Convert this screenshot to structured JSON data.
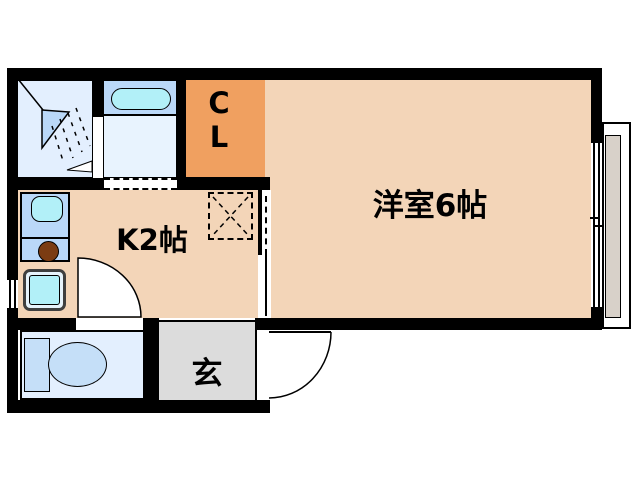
{
  "plan": {
    "rooms": {
      "western_room": {
        "label": "洋室6帖"
      },
      "kitchen": {
        "label": "K2帖"
      },
      "closet": {
        "label_top": "C",
        "label_bottom": "L"
      },
      "entrance_hall": {
        "label": "玄"
      }
    },
    "colors": {
      "wall": "#000000",
      "room_floor": "#f3d5b8",
      "closet_fill": "#f0a060",
      "entrance_floor": "#dcdcdc",
      "wet_room_floor": "#e3effe",
      "bath_floor": "#e8f3fe",
      "counter_blue": "#bad8f8",
      "fixture_cyan": "#b2f0f8",
      "toilet_blue": "#c5dff8",
      "burner_brown": "#7b3c12",
      "balcony_gray": "#d8d1c9",
      "pan_border": "#3f3f3f",
      "text": "#000000"
    },
    "icons": {
      "shower": "shower-spray-icon",
      "bathtub": "bathtub-icon",
      "kitchen_sink": "sink-icon",
      "stove": "stove-burner-icon",
      "washer": "washing-machine-pan-icon",
      "toilet": "toilet-icon",
      "refrigerator_space": "refrigerator-space-icon",
      "kitchen_toilet_door": "door-swing-icon",
      "entrance_door": "door-swing-icon",
      "main_window": "sliding-window-icon",
      "kitchen_window": "small-window-icon",
      "bath_door": "folding-door-icon"
    }
  }
}
